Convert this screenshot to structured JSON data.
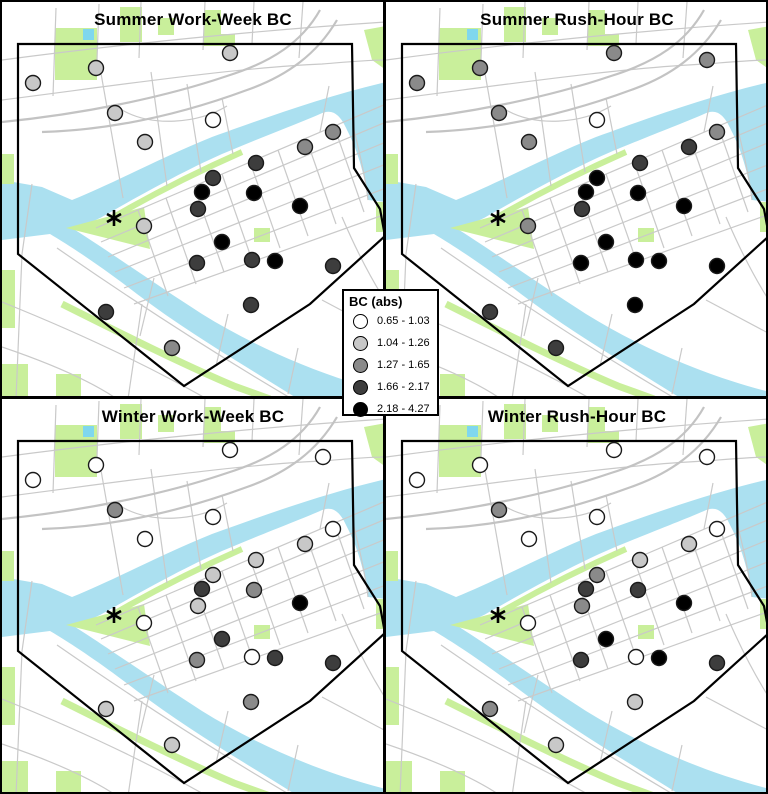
{
  "chart_data": {
    "type": "scatter",
    "title": "Black carbon (BC) concentrations by monitoring site, downtown study area",
    "legend": {
      "title": "BC (abs)",
      "classes": [
        {
          "label": "0.65 - 1.03",
          "color": "#ffffff"
        },
        {
          "label": "1.04 - 1.26",
          "color": "#c8c8c8"
        },
        {
          "label": "1.27 - 1.65",
          "color": "#8a8a8a"
        },
        {
          "label": "1.66 - 2.17",
          "color": "#3d3d3d"
        },
        {
          "label": "2.18 - 4.27",
          "color": "#000000"
        }
      ]
    },
    "sites": [
      {
        "x": 94,
        "y": 66
      },
      {
        "x": 31,
        "y": 81
      },
      {
        "x": 228,
        "y": 51
      },
      {
        "x": 321,
        "y": 58
      },
      {
        "x": 113,
        "y": 111
      },
      {
        "x": 211,
        "y": 118
      },
      {
        "x": 143,
        "y": 140
      },
      {
        "x": 331,
        "y": 130
      },
      {
        "x": 303,
        "y": 145
      },
      {
        "x": 254,
        "y": 161
      },
      {
        "x": 211,
        "y": 176
      },
      {
        "x": 200,
        "y": 190
      },
      {
        "x": 252,
        "y": 191
      },
      {
        "x": 196,
        "y": 207
      },
      {
        "x": 298,
        "y": 204
      },
      {
        "x": 142,
        "y": 224
      },
      {
        "x": 220,
        "y": 240
      },
      {
        "x": 195,
        "y": 261
      },
      {
        "x": 250,
        "y": 258
      },
      {
        "x": 273,
        "y": 259
      },
      {
        "x": 331,
        "y": 264
      },
      {
        "x": 249,
        "y": 303
      },
      {
        "x": 104,
        "y": 310
      },
      {
        "x": 170,
        "y": 346
      }
    ],
    "panels": [
      {
        "id": "summer-workweek",
        "title": "Summer Work-Week BC",
        "site_classes": [
          2,
          2,
          2,
          null,
          2,
          1,
          2,
          3,
          3,
          4,
          4,
          5,
          5,
          4,
          5,
          2,
          5,
          4,
          4,
          5,
          4,
          4,
          4,
          3
        ]
      },
      {
        "id": "summer-rushhour",
        "title": "Summer Rush-Hour BC",
        "site_classes": [
          3,
          3,
          3,
          3,
          3,
          1,
          3,
          3,
          4,
          4,
          5,
          5,
          5,
          4,
          5,
          3,
          5,
          5,
          5,
          5,
          5,
          5,
          4,
          4
        ]
      },
      {
        "id": "winter-workweek",
        "title": "Winter Work-Week BC",
        "site_classes": [
          1,
          1,
          1,
          1,
          3,
          1,
          1,
          1,
          2,
          2,
          2,
          4,
          3,
          2,
          5,
          1,
          4,
          3,
          1,
          4,
          4,
          3,
          2,
          2
        ]
      },
      {
        "id": "winter-rushhour",
        "title": "Winter Rush-Hour BC",
        "site_classes": [
          1,
          1,
          1,
          1,
          3,
          1,
          1,
          1,
          2,
          2,
          3,
          4,
          4,
          3,
          5,
          1,
          5,
          4,
          1,
          5,
          4,
          2,
          3,
          2
        ]
      }
    ],
    "map": {
      "water_color": "#abe0f0",
      "park_color": "#c9ef9b",
      "road_color": "#c9c9c9",
      "boundary_color": "#000000",
      "star_marker": {
        "symbol": "*",
        "x": 112,
        "y": 216
      }
    }
  }
}
